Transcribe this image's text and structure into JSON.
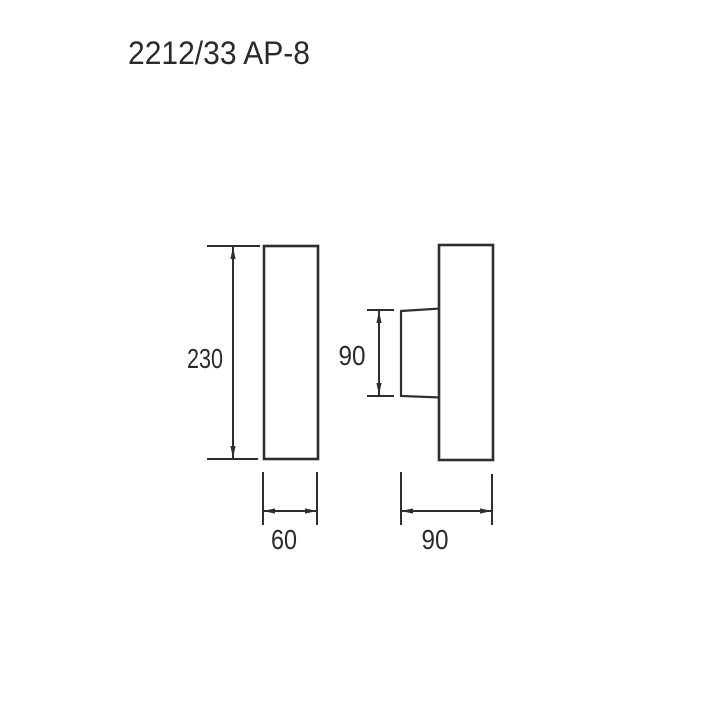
{
  "title": "2212/33 AP-8",
  "views": {
    "front": {
      "height_label": "230",
      "width_label": "60"
    },
    "side": {
      "projection_depth_label": "90",
      "width_label": "90"
    }
  },
  "colors": {
    "line": "#2e2e2e",
    "text": "#2a2a2a",
    "background": "#ffffff"
  }
}
